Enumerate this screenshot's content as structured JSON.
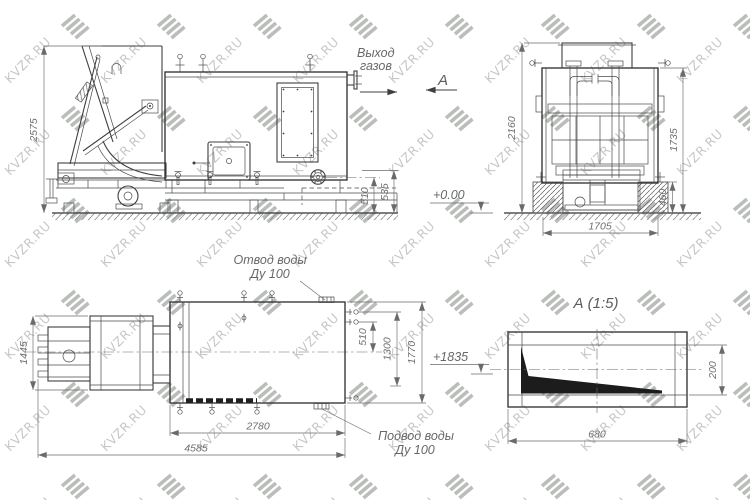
{
  "watermark": {
    "text": "KVZR.RU",
    "logo_icon": "kvzr-stripes-logo"
  },
  "colors": {
    "line": "#3f3f3f",
    "dimension": "#6a6a6a",
    "label_text": "#686868",
    "watermark_text": "#c6c9c6",
    "watermark_logo": "#b3b7b3",
    "background": "#ffffff",
    "detail_fill": "#1c1c1c"
  },
  "front_view": {
    "gas_outlet_label": [
      "Выход",
      "газов"
    ],
    "section_arrow_label": "А",
    "elevation_mark": "+0.00",
    "dims": {
      "total_height": "2575",
      "port_height": "510",
      "valve_height": "535"
    }
  },
  "end_view": {
    "dims": {
      "total_height": "2160",
      "body_height": "1735",
      "base_height": "460",
      "width": "1705"
    }
  },
  "plan_view": {
    "water_outlet_label": [
      "Отвод воды",
      "Ду 100"
    ],
    "water_inlet_label": [
      "Подвод воды",
      "Ду 100"
    ],
    "elevation_mark": "+1835",
    "dims": {
      "feeder_width": "1445",
      "port_offset": "510",
      "port_span": "1300",
      "body_width": "1770",
      "body_length": "2780",
      "total_length": "4585"
    }
  },
  "detail_view": {
    "title": "А (1:5)",
    "dims": {
      "height": "200",
      "length": "680"
    }
  }
}
